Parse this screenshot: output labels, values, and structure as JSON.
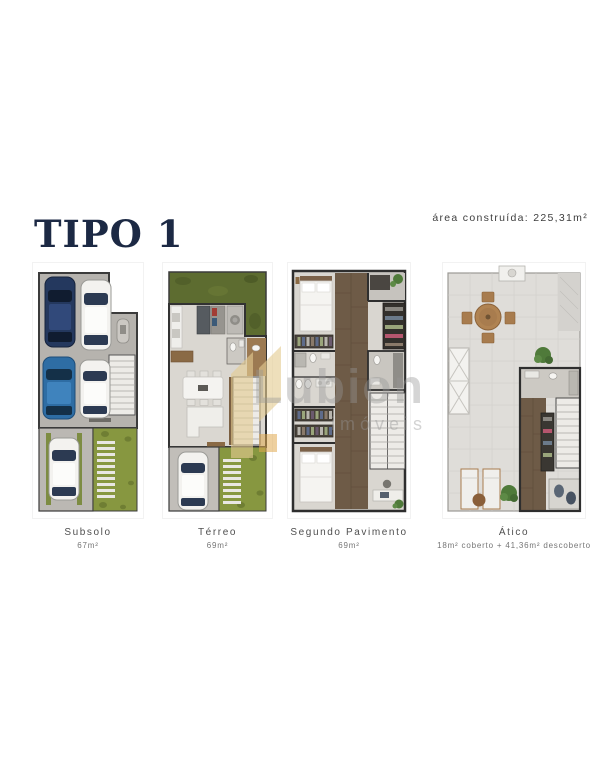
{
  "page": {
    "title": "TIPO 1",
    "area_note": "área construída: 225,31m²",
    "title_color": "#1c2944",
    "background": "#ffffff"
  },
  "plans": [
    {
      "name": "Subsolo",
      "area": "67m²"
    },
    {
      "name": "Térreo",
      "area": "69m²"
    },
    {
      "name": "Segundo Pavimento",
      "area": "69m²"
    },
    {
      "name": "Ático",
      "area": "18m² coberto + 41,36m² descoberto"
    }
  ],
  "watermark": {
    "brand": "Lubion",
    "brand_sub": "imóveis",
    "logo_color": "#e3cb92",
    "text_color": "#969696"
  },
  "palette": {
    "garage_floor": "#b6b3ae",
    "interior_floor": "#dad7d1",
    "terrace_tile": "#dfddd9",
    "lawn_green": "#879740",
    "garden_green": "#5d6c30",
    "wood_floor": "#6e5b47",
    "wall": "#2e2e2e",
    "car_navy": "#24385e",
    "car_blue": "#2e6da4",
    "car_white": "#f3f2ef",
    "label_text": "#4f4f4f"
  }
}
